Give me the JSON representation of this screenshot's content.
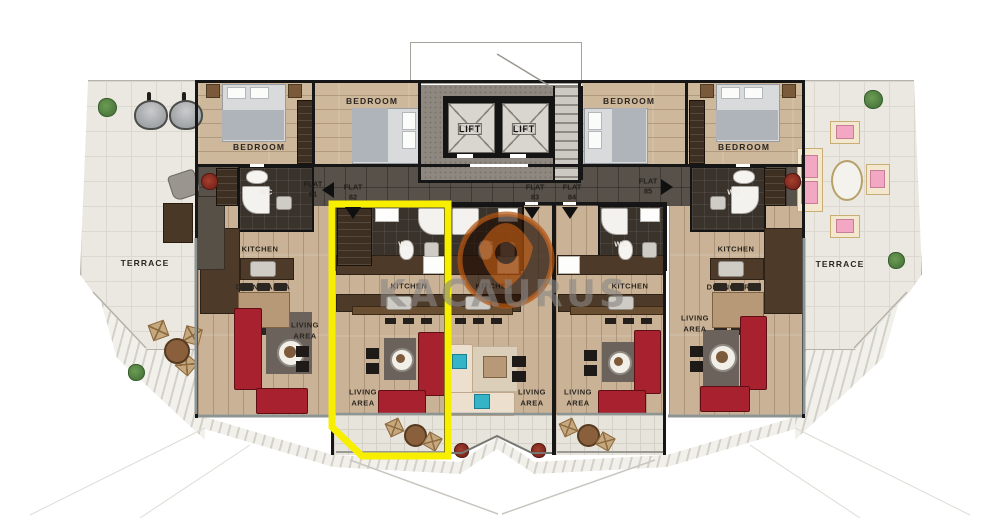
{
  "plan": {
    "watermark": "KACAURUS",
    "terrace_left_label": "TERRACE",
    "terrace_right_label": "TERRACE",
    "core": {
      "lift_left": "LIFT",
      "lift_right": "LIFT"
    },
    "flats": [
      {
        "name": "FLAT",
        "number": "81",
        "highlighted": false,
        "rooms": {
          "bedroom_a": "BEDROOM",
          "bedroom_b": "BEDROOM",
          "wc": "WC",
          "kitchen": "KITCHEN",
          "dining": "DINING AREA",
          "living": "LIVING AREA"
        }
      },
      {
        "name": "FLAT",
        "number": "82",
        "highlighted": true,
        "rooms": {
          "wc": "WC",
          "kitchen": "KITCHEN",
          "living": "LIVING AREA"
        }
      },
      {
        "name": "FLAT",
        "number": "83",
        "highlighted": false,
        "rooms": {
          "wc": "WC",
          "kitchen": "KITCHEN",
          "living": "LIVING AREA"
        }
      },
      {
        "name": "FLAT",
        "number": "84",
        "highlighted": false,
        "rooms": {
          "wc": "WC",
          "kitchen": "KITCHEN",
          "living": "LIVING AREA"
        }
      },
      {
        "name": "FLAT",
        "number": "85",
        "highlighted": false,
        "rooms": {
          "bedroom_a": "BEDROOM",
          "bedroom_b": "BEDROOM",
          "wc": "WC",
          "kitchen": "KITCHEN",
          "dining": "DINING AREA",
          "living": "LIVING AREA"
        }
      }
    ],
    "colors": {
      "highlight": "#f8ef00",
      "sofa_red": "#a7222e",
      "logo_orange": "#b4540f",
      "accent_teal": "#35b4c8"
    }
  }
}
